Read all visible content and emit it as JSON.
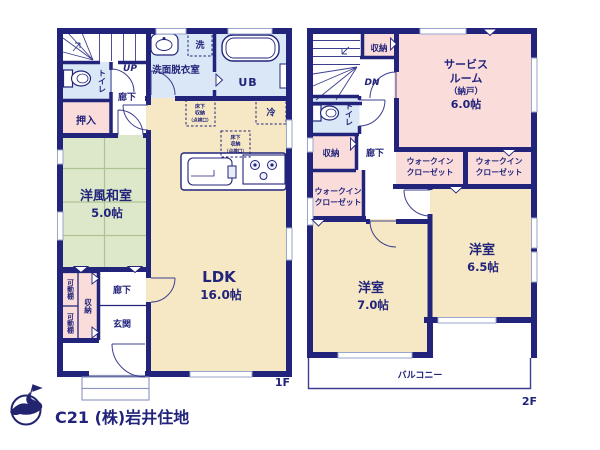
{
  "colors": {
    "wall": "#22247b",
    "room_cream": "#f6e8c5",
    "room_pink": "#fadddb",
    "room_blue": "#d9e7f6",
    "room_green": "#dce8c9",
    "logo_text": "#c7c7d4"
  },
  "floor1": {
    "floor_label": "1F",
    "stairs_direction": "UP",
    "toilet": "トイレ",
    "hallway_upper": "廊下",
    "closet_oshiire": "押入",
    "washroom": "洗面脱衣室",
    "laundry": "洗",
    "unit_bath": "UB",
    "fridge": "冷",
    "underfloor_l1": "床下",
    "underfloor_l2": "収納",
    "underfloor_l3": "（点検口）",
    "washitsu_name": "洋風和室",
    "washitsu_size": "5.0帖",
    "ldk_name": "LDK",
    "ldk_size": "16.0帖",
    "movable_shelf": "可動棚",
    "storage": "収納",
    "hallway_lower": "廊下",
    "entrance": "玄関"
  },
  "floor2": {
    "floor_label": "2F",
    "stairs_direction": "DN",
    "storage_top": "収納",
    "service_l1": "サービス",
    "service_l2": "ルーム",
    "service_l3": "（納戸）",
    "service_size": "6.0帖",
    "toilet": "トイレ",
    "storage_left": "収納",
    "hallway": "廊下",
    "wic_l1": "ウォークイン",
    "wic_l2": "クローゼット",
    "bedroom7_name": "洋室",
    "bedroom7_size": "7.0帖",
    "bedroom65_name": "洋室",
    "bedroom65_size": "6.5帖",
    "balcony": "バルコニー"
  },
  "footer": {
    "company": "C21 (株)岩井住地"
  }
}
